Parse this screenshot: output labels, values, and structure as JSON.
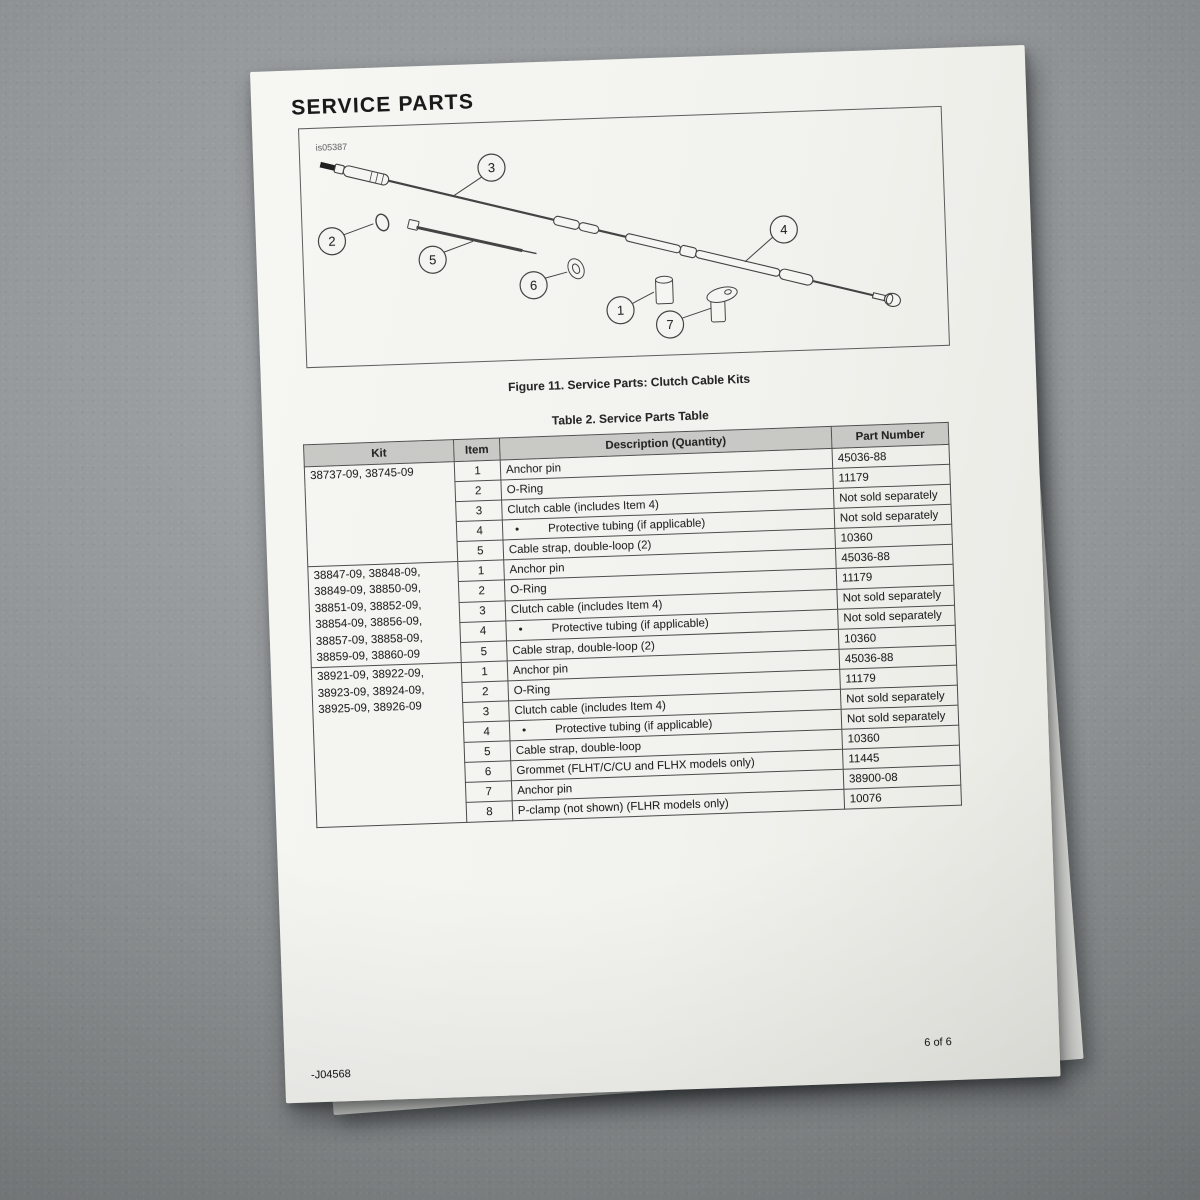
{
  "page": {
    "title": "SERVICE PARTS",
    "figure": {
      "image_code": "is05387",
      "caption": "Figure 11. Service Parts: Clutch Cable Kits",
      "callouts": [
        "1",
        "2",
        "3",
        "4",
        "5",
        "6",
        "7"
      ]
    },
    "table": {
      "caption": "Table 2. Service Parts Table",
      "headers": [
        "Kit",
        "Item",
        "Description (Quantity)",
        "Part Number"
      ],
      "bullet_char": "•",
      "groups": [
        {
          "kit_lines": [
            "38737-09, 38745-09"
          ],
          "rows": [
            {
              "item": "1",
              "description": "Anchor pin",
              "bullet": false,
              "part": "45036-88"
            },
            {
              "item": "2",
              "description": "O-Ring",
              "bullet": false,
              "part": "11179"
            },
            {
              "item": "3",
              "description": "Clutch cable (includes Item 4)",
              "bullet": false,
              "part": "Not sold separately"
            },
            {
              "item": "4",
              "description": "Protective tubing (if applicable)",
              "bullet": true,
              "part": "Not sold separately"
            },
            {
              "item": "5",
              "description": "Cable strap, double-loop (2)",
              "bullet": false,
              "part": "10360"
            }
          ]
        },
        {
          "kit_lines": [
            "38847-09, 38848-09,",
            "38849-09, 38850-09,",
            "38851-09, 38852-09,",
            "38854-09, 38856-09,",
            "38857-09, 38858-09,",
            "38859-09, 38860-09"
          ],
          "rows": [
            {
              "item": "1",
              "description": "Anchor pin",
              "bullet": false,
              "part": "45036-88"
            },
            {
              "item": "2",
              "description": "O-Ring",
              "bullet": false,
              "part": "11179"
            },
            {
              "item": "3",
              "description": "Clutch cable (includes Item 4)",
              "bullet": false,
              "part": "Not sold separately"
            },
            {
              "item": "4",
              "description": "Protective tubing (if applicable)",
              "bullet": true,
              "part": "Not sold separately"
            },
            {
              "item": "5",
              "description": "Cable strap, double-loop (2)",
              "bullet": false,
              "part": "10360"
            }
          ]
        },
        {
          "kit_lines": [
            "38921-09, 38922-09,",
            "38923-09, 38924-09,",
            "38925-09, 38926-09"
          ],
          "rows": [
            {
              "item": "1",
              "description": "Anchor pin",
              "bullet": false,
              "part": "45036-88"
            },
            {
              "item": "2",
              "description": "O-Ring",
              "bullet": false,
              "part": "11179"
            },
            {
              "item": "3",
              "description": "Clutch cable (includes Item 4)",
              "bullet": false,
              "part": "Not sold separately"
            },
            {
              "item": "4",
              "description": "Protective tubing (if applicable)",
              "bullet": true,
              "part": "Not sold separately"
            },
            {
              "item": "5",
              "description": "Cable strap, double-loop",
              "bullet": false,
              "part": "10360"
            },
            {
              "item": "6",
              "description": "Grommet (FLHT/C/CU and FLHX models only)",
              "bullet": false,
              "part": "11445"
            },
            {
              "item": "7",
              "description": "Anchor pin",
              "bullet": false,
              "part": "38900-08"
            },
            {
              "item": "8",
              "description": "P-clamp (not shown) (FLHR models only)",
              "bullet": false,
              "part": "10076"
            }
          ]
        }
      ]
    },
    "footer": {
      "page_indicator": "6 of 6",
      "form_number": "-J04568"
    }
  },
  "colors": {
    "surface_gray": "#8f9496",
    "paper_white": "#f2f2ee",
    "ink_black": "#1f1f1f",
    "table_header_gray": "#c7c7c4",
    "table_border_gray": "#4a4a4a"
  }
}
